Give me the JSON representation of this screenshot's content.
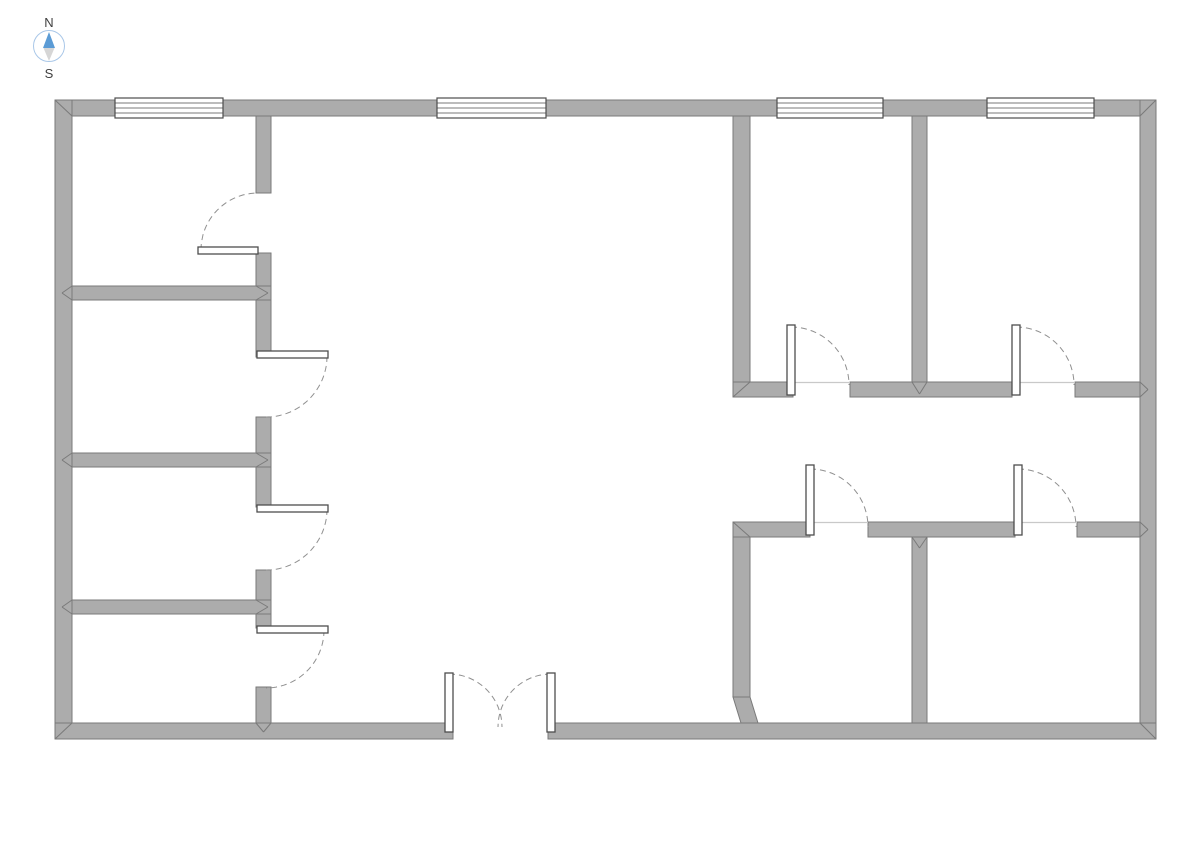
{
  "page": {
    "background": "#ffffff"
  },
  "compass": {
    "north_label": "N",
    "south_label": "S",
    "cx": 49,
    "cy": 46,
    "r": 15.5,
    "ring_color": "#a9c7e8",
    "north_color": "#5b9bd5",
    "south_color": "#d6d6d6",
    "label_color": "#404040"
  },
  "floorplan": {
    "colors": {
      "wall_fill": "#acacac",
      "wall_stroke": "#7a7a7a",
      "window_fill": "#ffffff",
      "window_stroke": "#4d4d4d",
      "leaf_fill": "#ffffff",
      "leaf_stroke": "#4d4d4d",
      "arc_stroke": "#909090",
      "threshold": "#c9c9c9"
    },
    "walls": [
      {
        "name": "exterior-top",
        "x": 55,
        "y": 100,
        "w": 1101,
        "h": 16
      },
      {
        "name": "exterior-left",
        "x": 55,
        "y": 100,
        "w": 17,
        "h": 639
      },
      {
        "name": "exterior-right",
        "x": 1140,
        "y": 100,
        "w": 16,
        "h": 639
      },
      {
        "name": "exterior-bottom-west",
        "x": 55,
        "y": 723,
        "w": 398,
        "h": 16
      },
      {
        "name": "exterior-bottom-east",
        "x": 548,
        "y": 723,
        "w": 608,
        "h": 16
      },
      {
        "name": "left-corridor-wall-seg1",
        "x": 256,
        "y": 116,
        "w": 15,
        "h": 77
      },
      {
        "name": "left-corridor-wall-seg2",
        "x": 256,
        "y": 253,
        "w": 15,
        "h": 104
      },
      {
        "name": "left-corridor-wall-seg3",
        "x": 256,
        "y": 417,
        "w": 15,
        "h": 90
      },
      {
        "name": "left-corridor-wall-seg4",
        "x": 256,
        "y": 570,
        "w": 15,
        "h": 58
      },
      {
        "name": "left-corridor-wall-seg5",
        "x": 256,
        "y": 687,
        "w": 15,
        "h": 36
      },
      {
        "name": "left-partition-1",
        "x": 72,
        "y": 286,
        "w": 199,
        "h": 14
      },
      {
        "name": "left-partition-2",
        "x": 72,
        "y": 453,
        "w": 199,
        "h": 14
      },
      {
        "name": "left-partition-3",
        "x": 72,
        "y": 600,
        "w": 199,
        "h": 14
      },
      {
        "name": "ne-room-wall-west",
        "x": 733,
        "y": 116,
        "w": 17,
        "h": 266
      },
      {
        "name": "ne-room-wall-mid",
        "x": 912,
        "y": 116,
        "w": 15,
        "h": 266
      },
      {
        "name": "ne-partition-seg1",
        "x": 733,
        "y": 382,
        "w": 60,
        "h": 15
      },
      {
        "name": "ne-partition-seg2",
        "x": 850,
        "y": 382,
        "w": 162,
        "h": 15
      },
      {
        "name": "ne-partition-seg3",
        "x": 1075,
        "y": 382,
        "w": 65,
        "h": 15
      },
      {
        "name": "se-partition-seg1",
        "x": 733,
        "y": 522,
        "w": 77,
        "h": 15
      },
      {
        "name": "se-partition-seg2",
        "x": 868,
        "y": 522,
        "w": 147,
        "h": 15
      },
      {
        "name": "se-partition-seg3",
        "x": 1077,
        "y": 522,
        "w": 63,
        "h": 15
      },
      {
        "name": "se-room-wall-west",
        "x": 733,
        "y": 537,
        "w": 17,
        "h": 160
      },
      {
        "name": "se-room-wall-mid",
        "x": 912,
        "y": 537,
        "w": 15,
        "h": 186
      }
    ],
    "diagonal_walls": [
      {
        "name": "se-wall-jog",
        "points": "733,697 750,697 758,723 741,723"
      }
    ],
    "windows": [
      {
        "name": "window-1",
        "x": 115,
        "y": 98,
        "w": 108,
        "h": 20,
        "lines": 3
      },
      {
        "name": "window-2",
        "x": 437,
        "y": 98,
        "w": 109,
        "h": 20,
        "lines": 3
      },
      {
        "name": "window-3",
        "x": 777,
        "y": 98,
        "w": 106,
        "h": 20,
        "lines": 3
      },
      {
        "name": "window-4",
        "x": 987,
        "y": 98,
        "w": 107,
        "h": 20,
        "lines": 3
      }
    ],
    "door_leaves": [
      {
        "name": "room1-door-leaf",
        "x": 198,
        "y": 247,
        "w": 60,
        "h": 7
      },
      {
        "name": "room2-door-leaf",
        "x": 257,
        "y": 351,
        "w": 71,
        "h": 7
      },
      {
        "name": "room3-door-leaf",
        "x": 257,
        "y": 505,
        "w": 71,
        "h": 7
      },
      {
        "name": "room4-door-leaf",
        "x": 257,
        "y": 626,
        "w": 71,
        "h": 7
      },
      {
        "name": "entrance-left-leaf",
        "x": 445,
        "y": 673,
        "w": 8,
        "h": 59
      },
      {
        "name": "entrance-right-leaf",
        "x": 547,
        "y": 673,
        "w": 8,
        "h": 59
      },
      {
        "name": "room5-door-leaf",
        "x": 787,
        "y": 325,
        "w": 8,
        "h": 70
      },
      {
        "name": "room6-door-leaf",
        "x": 1012,
        "y": 325,
        "w": 8,
        "h": 70
      },
      {
        "name": "room7-door-leaf",
        "x": 806,
        "y": 465,
        "w": 8,
        "h": 70
      },
      {
        "name": "room8-door-leaf",
        "x": 1014,
        "y": 465,
        "w": 8,
        "h": 70
      }
    ],
    "door_arcs": [
      {
        "name": "room1-door-arc",
        "cx": 258,
        "cy": 250,
        "r": 57,
        "a0": 180,
        "a1": 270
      },
      {
        "name": "room2-door-arc",
        "cx": 266,
        "cy": 356,
        "r": 61,
        "a0": 0,
        "a1": 90
      },
      {
        "name": "room3-door-arc",
        "cx": 266,
        "cy": 509,
        "r": 61,
        "a0": 0,
        "a1": 90
      },
      {
        "name": "room4-door-arc",
        "cx": 266,
        "cy": 630,
        "r": 58,
        "a0": 0,
        "a1": 90
      },
      {
        "name": "entrance-left-arc",
        "cx": 449,
        "cy": 727,
        "r": 53,
        "a0": 270,
        "a1": 360
      },
      {
        "name": "entrance-right-arc",
        "cx": 551,
        "cy": 727,
        "r": 53,
        "a0": 270,
        "a1": 180
      },
      {
        "name": "room5-door-arc",
        "cx": 791,
        "cy": 385,
        "r": 58,
        "a0": 270,
        "a1": 360
      },
      {
        "name": "room6-door-arc",
        "cx": 1016,
        "cy": 385,
        "r": 58,
        "a0": 270,
        "a1": 360
      },
      {
        "name": "room7-door-arc",
        "cx": 810,
        "cy": 527,
        "r": 58,
        "a0": 270,
        "a1": 360
      },
      {
        "name": "room8-door-arc",
        "cx": 1018,
        "cy": 527,
        "r": 58,
        "a0": 270,
        "a1": 360
      }
    ],
    "thresholds": [
      {
        "x1": 793,
        "y1": 382.5,
        "x2": 850,
        "y2": 382.5
      },
      {
        "x1": 1012,
        "y1": 382.5,
        "x2": 1075,
        "y2": 382.5
      },
      {
        "x1": 810,
        "y1": 522.5,
        "x2": 868,
        "y2": 522.5
      },
      {
        "x1": 1015,
        "y1": 522.5,
        "x2": 1077,
        "y2": 522.5
      }
    ],
    "miters": [
      {
        "x1": 55,
        "y1": 100,
        "x2": 72,
        "y2": 116
      },
      {
        "x1": 1156,
        "y1": 100,
        "x2": 1140,
        "y2": 116
      },
      {
        "x1": 55,
        "y1": 739,
        "x2": 72,
        "y2": 723
      },
      {
        "x1": 1156,
        "y1": 739,
        "x2": 1140,
        "y2": 723
      },
      {
        "x1": 72,
        "y1": 286,
        "x2": 62,
        "y2": 293
      },
      {
        "x1": 72,
        "y1": 300,
        "x2": 62,
        "y2": 293
      },
      {
        "x1": 256,
        "y1": 286,
        "x2": 268,
        "y2": 293
      },
      {
        "x1": 256,
        "y1": 300,
        "x2": 268,
        "y2": 293
      },
      {
        "x1": 72,
        "y1": 453,
        "x2": 62,
        "y2": 460
      },
      {
        "x1": 72,
        "y1": 467,
        "x2": 62,
        "y2": 460
      },
      {
        "x1": 256,
        "y1": 453,
        "x2": 268,
        "y2": 460
      },
      {
        "x1": 256,
        "y1": 467,
        "x2": 268,
        "y2": 460
      },
      {
        "x1": 72,
        "y1": 600,
        "x2": 62,
        "y2": 607
      },
      {
        "x1": 72,
        "y1": 614,
        "x2": 62,
        "y2": 607
      },
      {
        "x1": 256,
        "y1": 600,
        "x2": 268,
        "y2": 607
      },
      {
        "x1": 256,
        "y1": 614,
        "x2": 268,
        "y2": 607
      },
      {
        "x1": 912,
        "y1": 382,
        "x2": 919.5,
        "y2": 394
      },
      {
        "x1": 927,
        "y1": 382,
        "x2": 919.5,
        "y2": 394
      },
      {
        "x1": 733,
        "y1": 397,
        "x2": 750,
        "y2": 382
      },
      {
        "x1": 733,
        "y1": 522,
        "x2": 750,
        "y2": 537
      },
      {
        "x1": 1140,
        "y1": 382,
        "x2": 1148,
        "y2": 389.5
      },
      {
        "x1": 1140,
        "y1": 397,
        "x2": 1148,
        "y2": 389.5
      },
      {
        "x1": 1140,
        "y1": 522,
        "x2": 1148,
        "y2": 529.5
      },
      {
        "x1": 1140,
        "y1": 537,
        "x2": 1148,
        "y2": 529.5
      },
      {
        "x1": 912,
        "y1": 537,
        "x2": 919.5,
        "y2": 548
      },
      {
        "x1": 927,
        "y1": 537,
        "x2": 919.5,
        "y2": 548
      },
      {
        "x1": 256,
        "y1": 723,
        "x2": 263.5,
        "y2": 732
      },
      {
        "x1": 271,
        "y1": 723,
        "x2": 263.5,
        "y2": 732
      }
    ]
  }
}
